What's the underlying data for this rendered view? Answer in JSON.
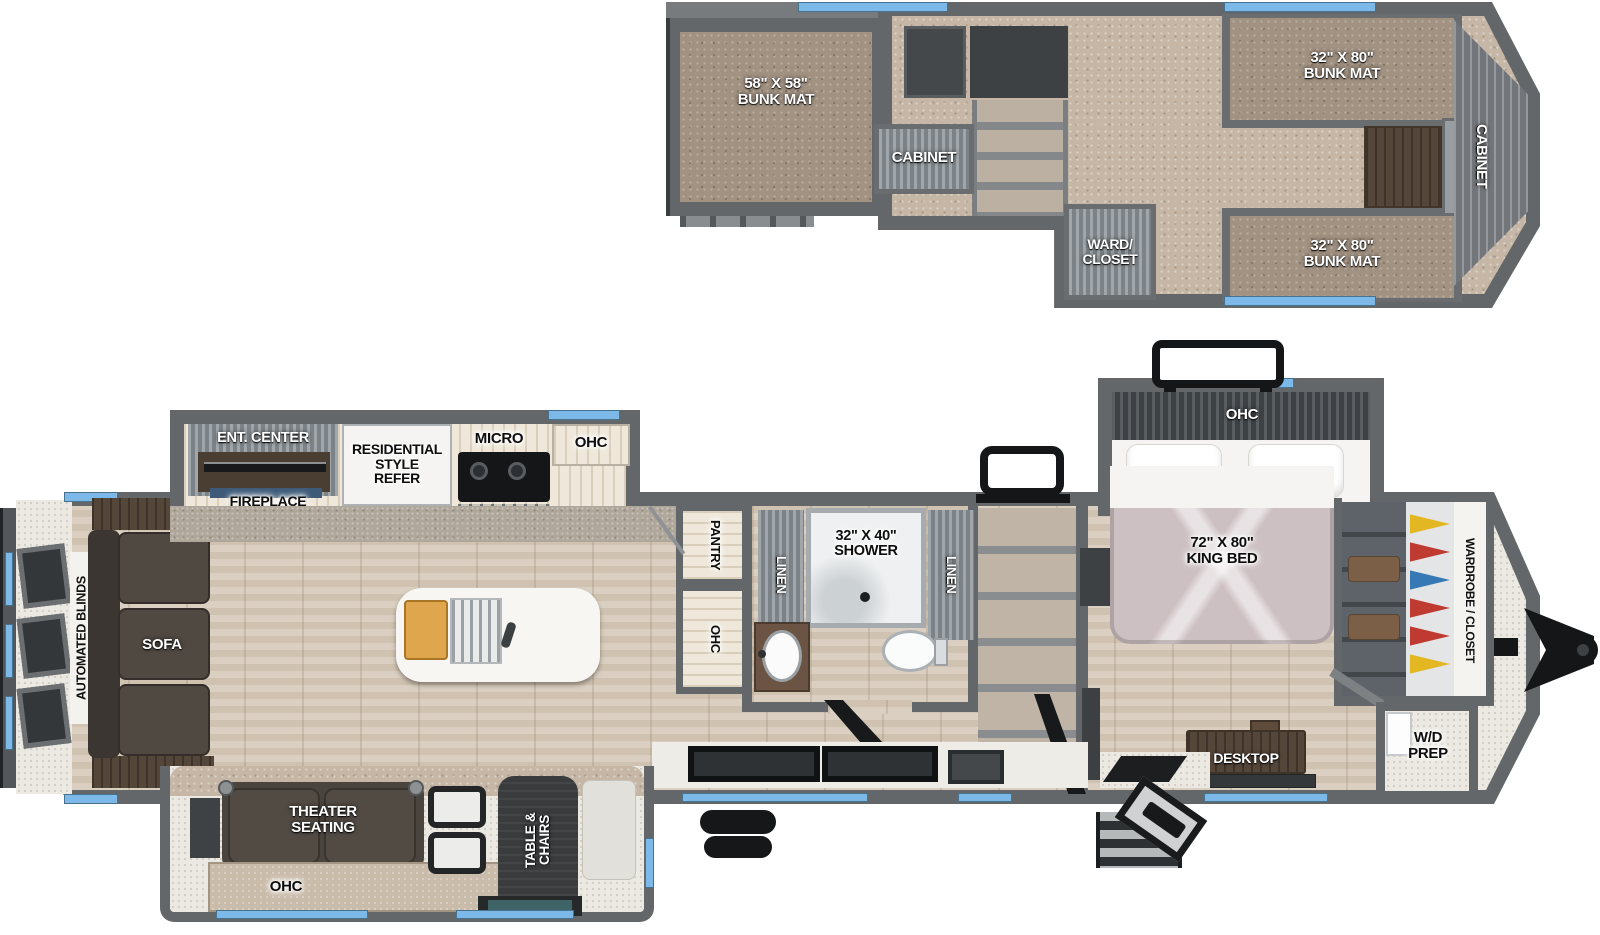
{
  "colors": {
    "window_blue": "#7db9e8",
    "wall_gray": "#64676a",
    "wood_floor": "#d6cab9",
    "carpet_tan": "#c5b6a6",
    "bunk_mat": "#a29282",
    "bed_mauve": "#cdc0c3",
    "furniture_dark": "#46413c",
    "counter_speckle": "#b0a79b",
    "clothes_colors": [
      "#e3b722",
      "#bf3a31",
      "#3679b5"
    ]
  },
  "loft": {
    "bunk_left": "58\" X 58\"\nBUNK MAT",
    "cabinet_mid": "CABINET",
    "ward_closet": "WARD/\nCLOSET",
    "bunk_top": "32\" X 80\"\nBUNK MAT",
    "bunk_bottom": "32\" X 80\"\nBUNK MAT",
    "cabinet_front": "CABINET"
  },
  "main": {
    "automated_blinds": "AUTOMATED BLINDS",
    "sofa": "SOFA",
    "ent_center": "ENT. CENTER",
    "fireplace": "FIREPLACE",
    "refer": "RESIDENTIAL\nSTYLE\nREFER",
    "micro": "MICRO",
    "ohc_kitchen": "OHC",
    "pantry": "PANTRY",
    "ohc_hall": "OHC",
    "linen_left": "LINEN",
    "shower": "32\" X 40\"\nSHOWER",
    "linen_right": "LINEN",
    "ohc_bedroom": "OHC",
    "king_bed": "72\" X 80\"\nKING BED",
    "wardrobe": "WARDROBE / CLOSET",
    "desktop": "DESKTOP",
    "wd_prep": "W/D\nPREP",
    "theater": "THEATER\nSEATING",
    "ohc_theater": "OHC",
    "table_chairs": "TABLE &\nCHAIRS"
  }
}
